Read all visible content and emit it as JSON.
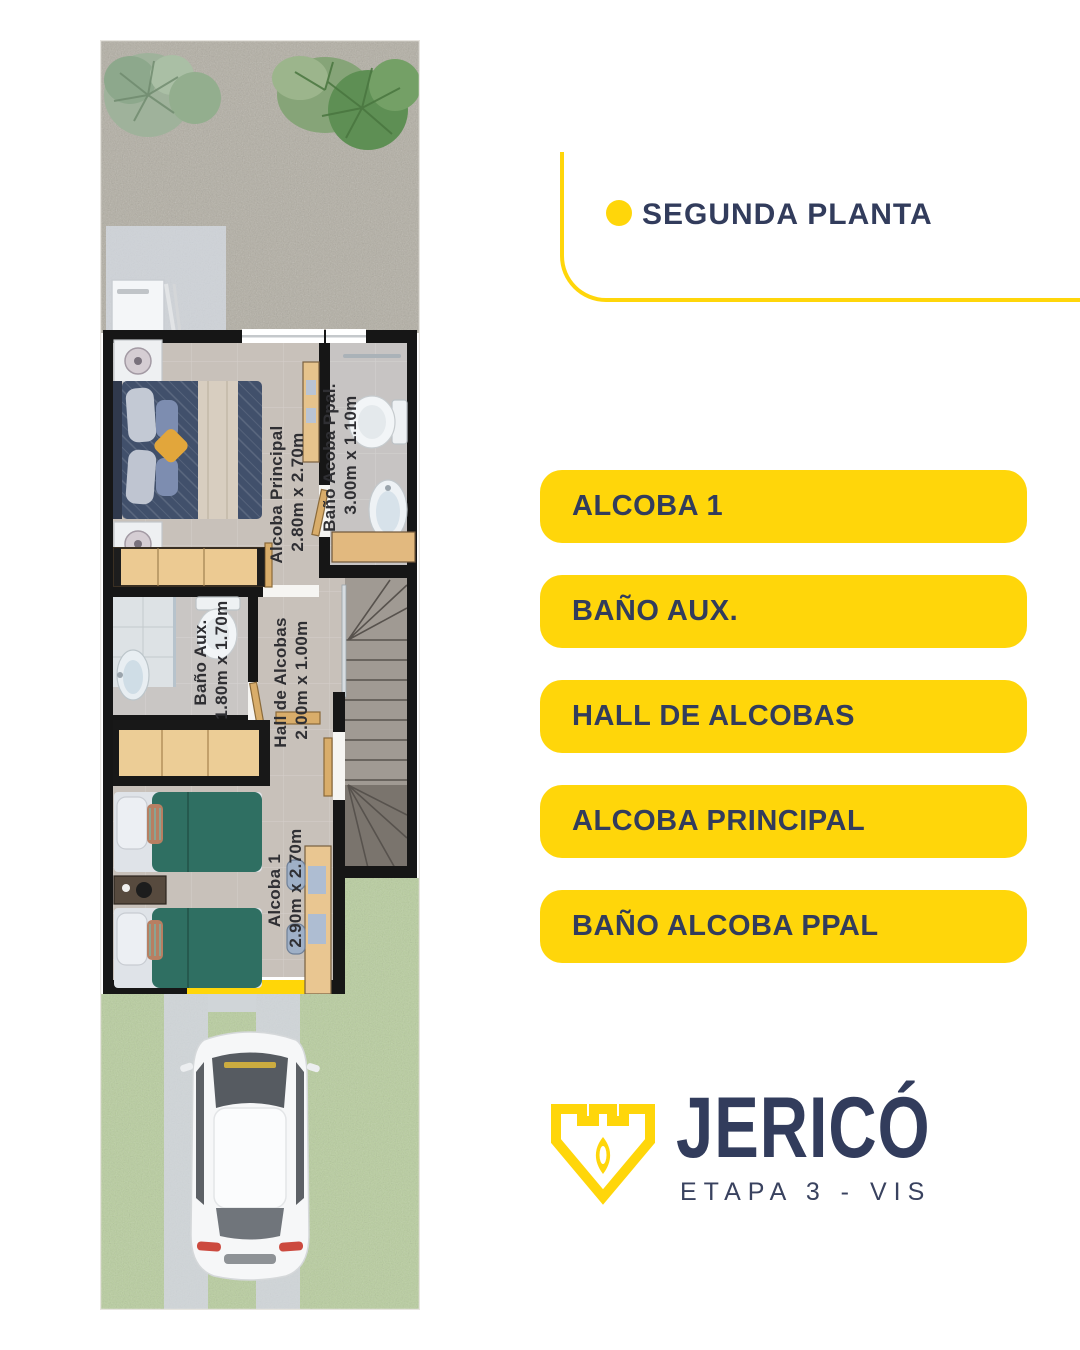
{
  "header": {
    "title": "SEGUNDA PLANTA"
  },
  "legend": {
    "items": [
      {
        "label": "ALCOBA 1"
      },
      {
        "label": "BAÑO AUX."
      },
      {
        "label": "HALL DE ALCOBAS"
      },
      {
        "label": "ALCOBA PRINCIPAL"
      },
      {
        "label": "BAÑO ALCOBA PPAL"
      }
    ]
  },
  "floorplan": {
    "rooms": [
      {
        "name": "Alcoba Principal",
        "dimensions": "2.80m x 2.70m"
      },
      {
        "name": "Baño Acoba Ppal.",
        "dimensions": "3.00m x 1.10m"
      },
      {
        "name": "Baño Aux.",
        "dimensions": "1.80m x 1.70m"
      },
      {
        "name": "Hall de Alcobas",
        "dimensions": "2.00m x 1.00m"
      },
      {
        "name": "Alcoba 1",
        "dimensions": "2.90m x 2.70m"
      }
    ]
  },
  "brand": {
    "name": "JERICÓ",
    "subtitle": "ETAPA 3 - VIS"
  },
  "colors": {
    "accent_yellow": "#FFD60A",
    "navy": "#323C5C"
  }
}
